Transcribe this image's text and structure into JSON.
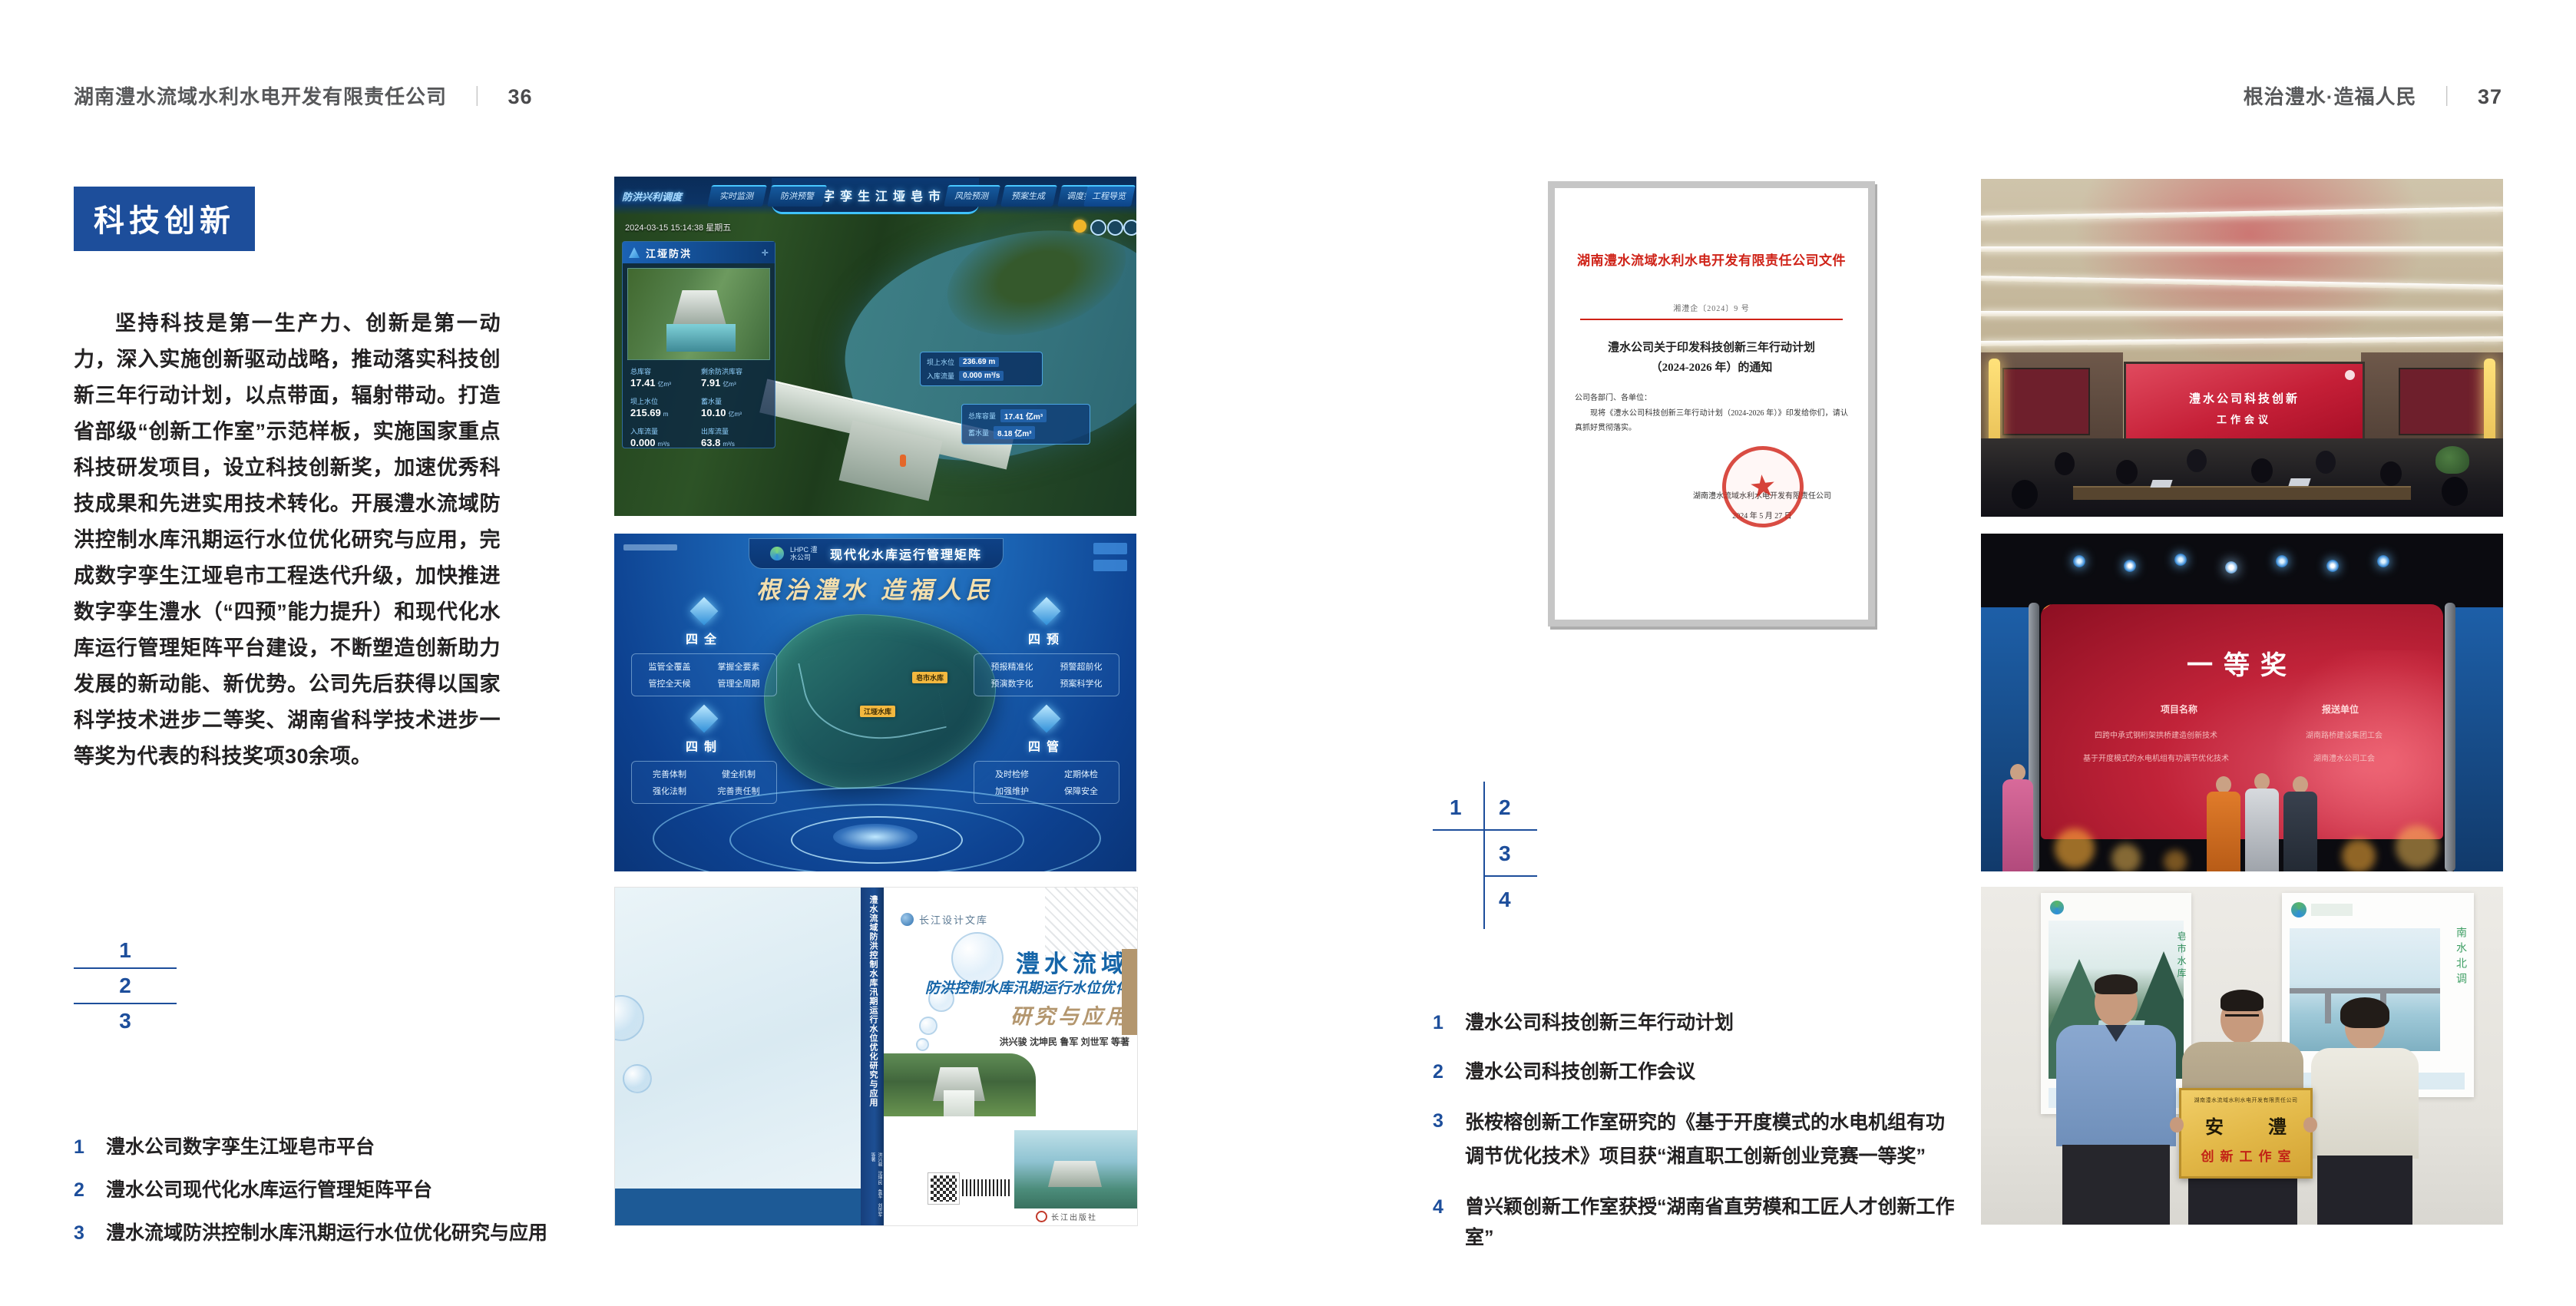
{
  "colors": {
    "accent_blue": "#1d4e9b",
    "doc_red": "#cf2217"
  },
  "left_page": {
    "header_title": "湖南澧水流域水利水电开发有限责任公司",
    "header_sep": "｜",
    "page_number": "36",
    "section_title": "科技创新",
    "body": "坚持科技是第一生产力、创新是第一动力，深入实施创新驱动战略，推动落实科技创新三年行动计划，以点带面，辐射带动。打造省部级“创新工作室”示范样板，实施国家重点科技研发项目，设立科技创新奖，加速优秀科技成果和先进实用技术转化。开展澧水流域防洪控制水库汛期运行水位优化研究与应用，完成数字孪生江垭皂市工程迭代升级，加快推进数字孪生澧水（“四预”能力提升）和现代化水库运行管理矩阵平台建设，不断塑造创新助力发展的新动能、新优势。公司先后获得以国家科学技术进步二等奖、湖南省科学技术进步一等奖为代表的科技奖项30余项。",
    "figure_index": [
      "1",
      "2",
      "3"
    ],
    "captions": [
      {
        "num": "1",
        "text": "澧水公司数字孪生江垭皂市平台"
      },
      {
        "num": "2",
        "text": "澧水公司现代化水库运行管理矩阵平台"
      },
      {
        "num": "3",
        "text": "澧水流域防洪控制水库汛期运行水位优化研究与应用"
      }
    ]
  },
  "right_page": {
    "header_title": "根治澧水·造福人民",
    "header_sep": "｜",
    "page_number": "37",
    "figure_index": [
      "1",
      "2",
      "3",
      "4"
    ],
    "captions": [
      {
        "num": "1",
        "text": "澧水公司科技创新三年行动计划"
      },
      {
        "num": "2",
        "text": "澧水公司科技创新工作会议"
      },
      {
        "num": "3",
        "text": "张桉榕创新工作室研究的《基于开度模式的水电机组有功调节优化技术》项目获“湘直职工创新创业竞赛一等奖”"
      },
      {
        "num": "4",
        "text": "曾兴颖创新工作室获授“湖南省直劳模和工匠人才创新工作室”"
      }
    ]
  },
  "dashboard": {
    "title": "数字孪生江垭皂市",
    "nav_label": "防洪兴利调度",
    "tabs_left": [
      "实时监测",
      "洪水预报",
      "防洪预警"
    ],
    "tabs_right": [
      "风险预测",
      "预案生成",
      "调度执行",
      "工程导览"
    ],
    "timestamp": "2024-03-15 15:14:38 星期五",
    "panel_title": "江垭防洪",
    "stats": [
      {
        "label": "总库容",
        "value": "17.41",
        "unit": "亿m³"
      },
      {
        "label": "剩余防洪库容",
        "value": "7.91",
        "unit": "亿m³"
      },
      {
        "label": "坝上水位",
        "value": "215.69",
        "unit": "m"
      },
      {
        "label": "蓄水量",
        "value": "10.10",
        "unit": "亿m³"
      },
      {
        "label": "入库流量",
        "value": "0.000",
        "unit": "m³/s"
      },
      {
        "label": "出库流量",
        "value": "63.8",
        "unit": "m³/s"
      }
    ],
    "tooltip": [
      {
        "label": "坝上水位",
        "value": "236.69 m"
      },
      {
        "label": "入库流量",
        "value": "0.000 m³/s"
      }
    ],
    "side_card": [
      {
        "label": "总库容量",
        "value": "17.41 亿m³"
      },
      {
        "label": "蓄水量",
        "value": "8.18 亿m³"
      }
    ]
  },
  "matrix": {
    "logo_text": "LHPC 澧水公司",
    "title": "现代化水库运行管理矩阵",
    "slogan": "根治澧水 造福人民",
    "groups": [
      {
        "label": "四全",
        "items": [
          "监管全覆盖",
          "掌握全要素",
          "管控全天候",
          "管理全周期"
        ]
      },
      {
        "label": "四预",
        "items": [
          "预报精准化",
          "预警超前化",
          "预演数字化",
          "预案科学化"
        ]
      },
      {
        "label": "四制",
        "items": [
          "完善体制",
          "健全机制",
          "强化法制",
          "完善责任制"
        ]
      },
      {
        "label": "四管",
        "items": [
          "及时检修",
          "定期体检",
          "加强维护",
          "保障安全"
        ]
      }
    ],
    "map_labels": [
      "江垭水库",
      "皂市水库"
    ]
  },
  "book": {
    "series_logo": "长江设计文库",
    "title_line1": "澧水流域",
    "title_line2": "防洪控制水库汛期运行水位优化",
    "title_line3": "研究与应用",
    "authors": "洪兴骏  沈坤民  鲁军  刘世军  等著",
    "spine_text": "澧水流域防洪控制水库汛期运行水位优化研究与应用",
    "publisher": "长江出版社"
  },
  "photo_meeting": {
    "screen_line1": "澧水公司科技创新",
    "screen_line2": "工作会议"
  },
  "photo_award": {
    "title": "一等奖",
    "col1_header": "项目名称",
    "col2_header": "报送单位",
    "rows": [
      {
        "project": "四跨中承式钢桁架拱桥建造创新技术",
        "org": "湖南路桥建设集团工会"
      },
      {
        "project": "基于开度模式的水电机组有功调节优化技术",
        "org": "湖南澧水公司工会"
      }
    ]
  },
  "photo_group": {
    "plaque_header": "湖南澧水流域水利水电开发有限责任公司",
    "plaque_title": "安 澧",
    "plaque_subtitle": "创新工作室",
    "poster_left_caption": "皂市水库",
    "poster_right_caption": "南水北调"
  },
  "document": {
    "red_title": "湖南澧水流域水利水电开发有限责任公司文件",
    "doc_number": "湘澧企〔2024〕9 号",
    "subject_line1": "澧水公司关于印发科技创新三年行动计划",
    "subject_line2": "（2024-2026 年）的通知",
    "greeting": "公司各部门、各单位：",
    "body": "现将《澧水公司科技创新三年行动计划（2024-2026 年）》印发给你们，请认真抓好贯彻落实。",
    "signature": "湖南澧水流域水利水电开发有限责任公司",
    "date": "2024 年 5 月 27 日"
  }
}
